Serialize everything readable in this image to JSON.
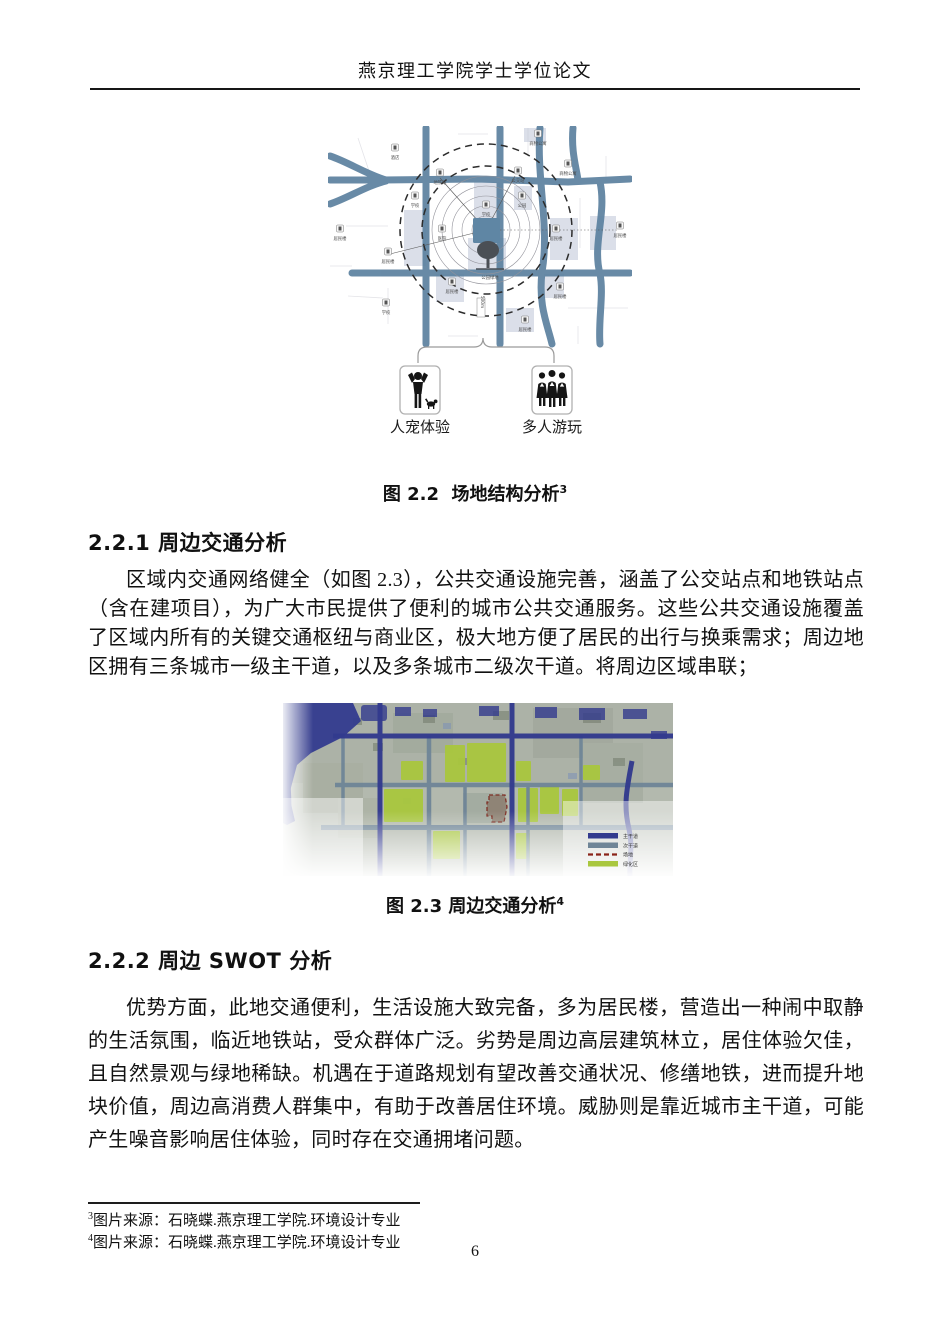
{
  "page": {
    "header": "燕京理工学院学士学位论文",
    "page_number": "6"
  },
  "figure22": {
    "caption": "图 2.2  场地结构分析",
    "caption_sup": "3",
    "icon_labels": [
      "人宠体验",
      "多人游玩"
    ],
    "map_labels": [
      "酒店",
      "地铁站",
      "公交站",
      "商物公寓",
      "商物公寓",
      "学校",
      "学校",
      "公园",
      "医院",
      "居民楼",
      "居民楼",
      "居民楼",
      "居民楼",
      "居民楼",
      "居民楼",
      "居民楼",
      "学校",
      "公园绿地",
      "500m"
    ]
  },
  "section221": {
    "heading": "2.2.1 周边交通分析",
    "paragraph": "区域内交通网络健全（如图 2.3），公共交通设施完善，涵盖了公交站点和地铁站点（含在建项目），为广大市民提供了便利的城市公共交通服务。这些公共交通设施覆盖了区域内所有的关键交通枢纽与商业区，极大地方便了居民的出行与换乘需求；周边地区拥有三条城市一级主干道，以及多条城市二级次干道。将周边区域串联；"
  },
  "figure23": {
    "caption": "图 2.3 周边交通分析",
    "caption_sup": "4",
    "legend": [
      "主干道",
      "次干道",
      "场地",
      "绿化区"
    ]
  },
  "section222": {
    "heading": "2.2.2 周边 SWOT 分析",
    "paragraph": "优势方面，此地交通便利，生活设施大致完备，多为居民楼，营造出一种闹中取静的生活氛围，临近地铁站，受众群体广泛。劣势是周边高层建筑林立，居住体验欠佳，且自然景观与绿地稀缺。机遇在于道路规划有望改善交通状况、修缮地铁，进而提升地块价值，周边高消费人群集中，有助于改善居住环境。威胁则是靠近城市主干道，可能产生噪音影响居住体验，同时存在交通拥堵问题。"
  },
  "footnotes": [
    {
      "sup": "3",
      "text": "图片来源：石晓蝶.燕京理工学院.环境设计专业"
    },
    {
      "sup": "4",
      "text": "图片来源：石晓蝶.燕京理工学院.环境设计专业"
    }
  ],
  "colors": {
    "road_blue": "#5d82a0",
    "main_road_navy": "#333b8e",
    "secondary_road": "#6f8597",
    "green_zone": "#a9c73e",
    "site_outline": "#7a2117"
  }
}
